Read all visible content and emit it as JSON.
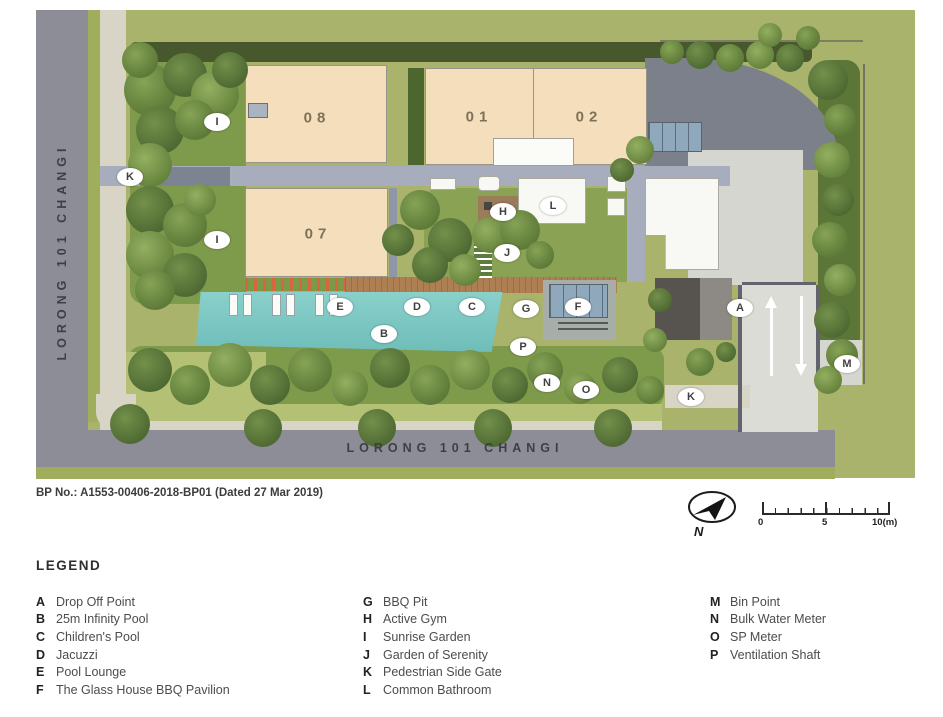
{
  "plan": {
    "road_left_label": "LORONG 101 CHANGI",
    "road_bottom_label": "LORONG 101 CHANGI",
    "buildings": [
      {
        "label": "08"
      },
      {
        "label": "01"
      },
      {
        "label": "02"
      },
      {
        "label": "07"
      }
    ],
    "markers": [
      {
        "letter": "I",
        "x": 217,
        "y": 122
      },
      {
        "letter": "K",
        "x": 130,
        "y": 177
      },
      {
        "letter": "I",
        "x": 217,
        "y": 240
      },
      {
        "letter": "H",
        "x": 503,
        "y": 212
      },
      {
        "letter": "L",
        "x": 553,
        "y": 206
      },
      {
        "letter": "J",
        "x": 507,
        "y": 253
      },
      {
        "letter": "E",
        "x": 340,
        "y": 307
      },
      {
        "letter": "D",
        "x": 417,
        "y": 307
      },
      {
        "letter": "C",
        "x": 472,
        "y": 307
      },
      {
        "letter": "G",
        "x": 526,
        "y": 309
      },
      {
        "letter": "F",
        "x": 578,
        "y": 307
      },
      {
        "letter": "B",
        "x": 384,
        "y": 334
      },
      {
        "letter": "P",
        "x": 523,
        "y": 347
      },
      {
        "letter": "N",
        "x": 547,
        "y": 383
      },
      {
        "letter": "O",
        "x": 586,
        "y": 390
      },
      {
        "letter": "A",
        "x": 740,
        "y": 308
      },
      {
        "letter": "M",
        "x": 847,
        "y": 364
      },
      {
        "letter": "K",
        "x": 691,
        "y": 397
      }
    ],
    "colors": {
      "building_fill": "#f5debc",
      "pool": "#7cc5c0",
      "road": "#8d8d97",
      "grass": "#a9b36c",
      "walkway": "#a7adbc",
      "deck": "#ad7f52"
    }
  },
  "footer": {
    "bp_line": "BP No.: A1553-00406-2018-BP01 (Dated 27 Mar 2019)",
    "north_label": "N",
    "scale": {
      "start": "0",
      "mid": "5",
      "end": "10(m)"
    }
  },
  "legend": {
    "title": "LEGEND",
    "columns": [
      [
        {
          "letter": "A",
          "label": "Drop Off Point"
        },
        {
          "letter": "B",
          "label": "25m Infinity Pool"
        },
        {
          "letter": "C",
          "label": "Children's Pool"
        },
        {
          "letter": "D",
          "label": "Jacuzzi"
        },
        {
          "letter": "E",
          "label": "Pool Lounge"
        },
        {
          "letter": "F",
          "label": "The Glass House BBQ Pavilion"
        }
      ],
      [
        {
          "letter": "G",
          "label": "BBQ Pit"
        },
        {
          "letter": "H",
          "label": "Active Gym"
        },
        {
          "letter": "I",
          "label": "Sunrise Garden"
        },
        {
          "letter": "J",
          "label": "Garden of Serenity"
        },
        {
          "letter": "K",
          "label": "Pedestrian Side Gate"
        },
        {
          "letter": "L",
          "label": "Common Bathroom"
        }
      ],
      [
        {
          "letter": "M",
          "label": "Bin Point"
        },
        {
          "letter": "N",
          "label": "Bulk Water Meter"
        },
        {
          "letter": "O",
          "label": "SP Meter"
        },
        {
          "letter": "P",
          "label": "Ventilation Shaft"
        }
      ]
    ]
  }
}
